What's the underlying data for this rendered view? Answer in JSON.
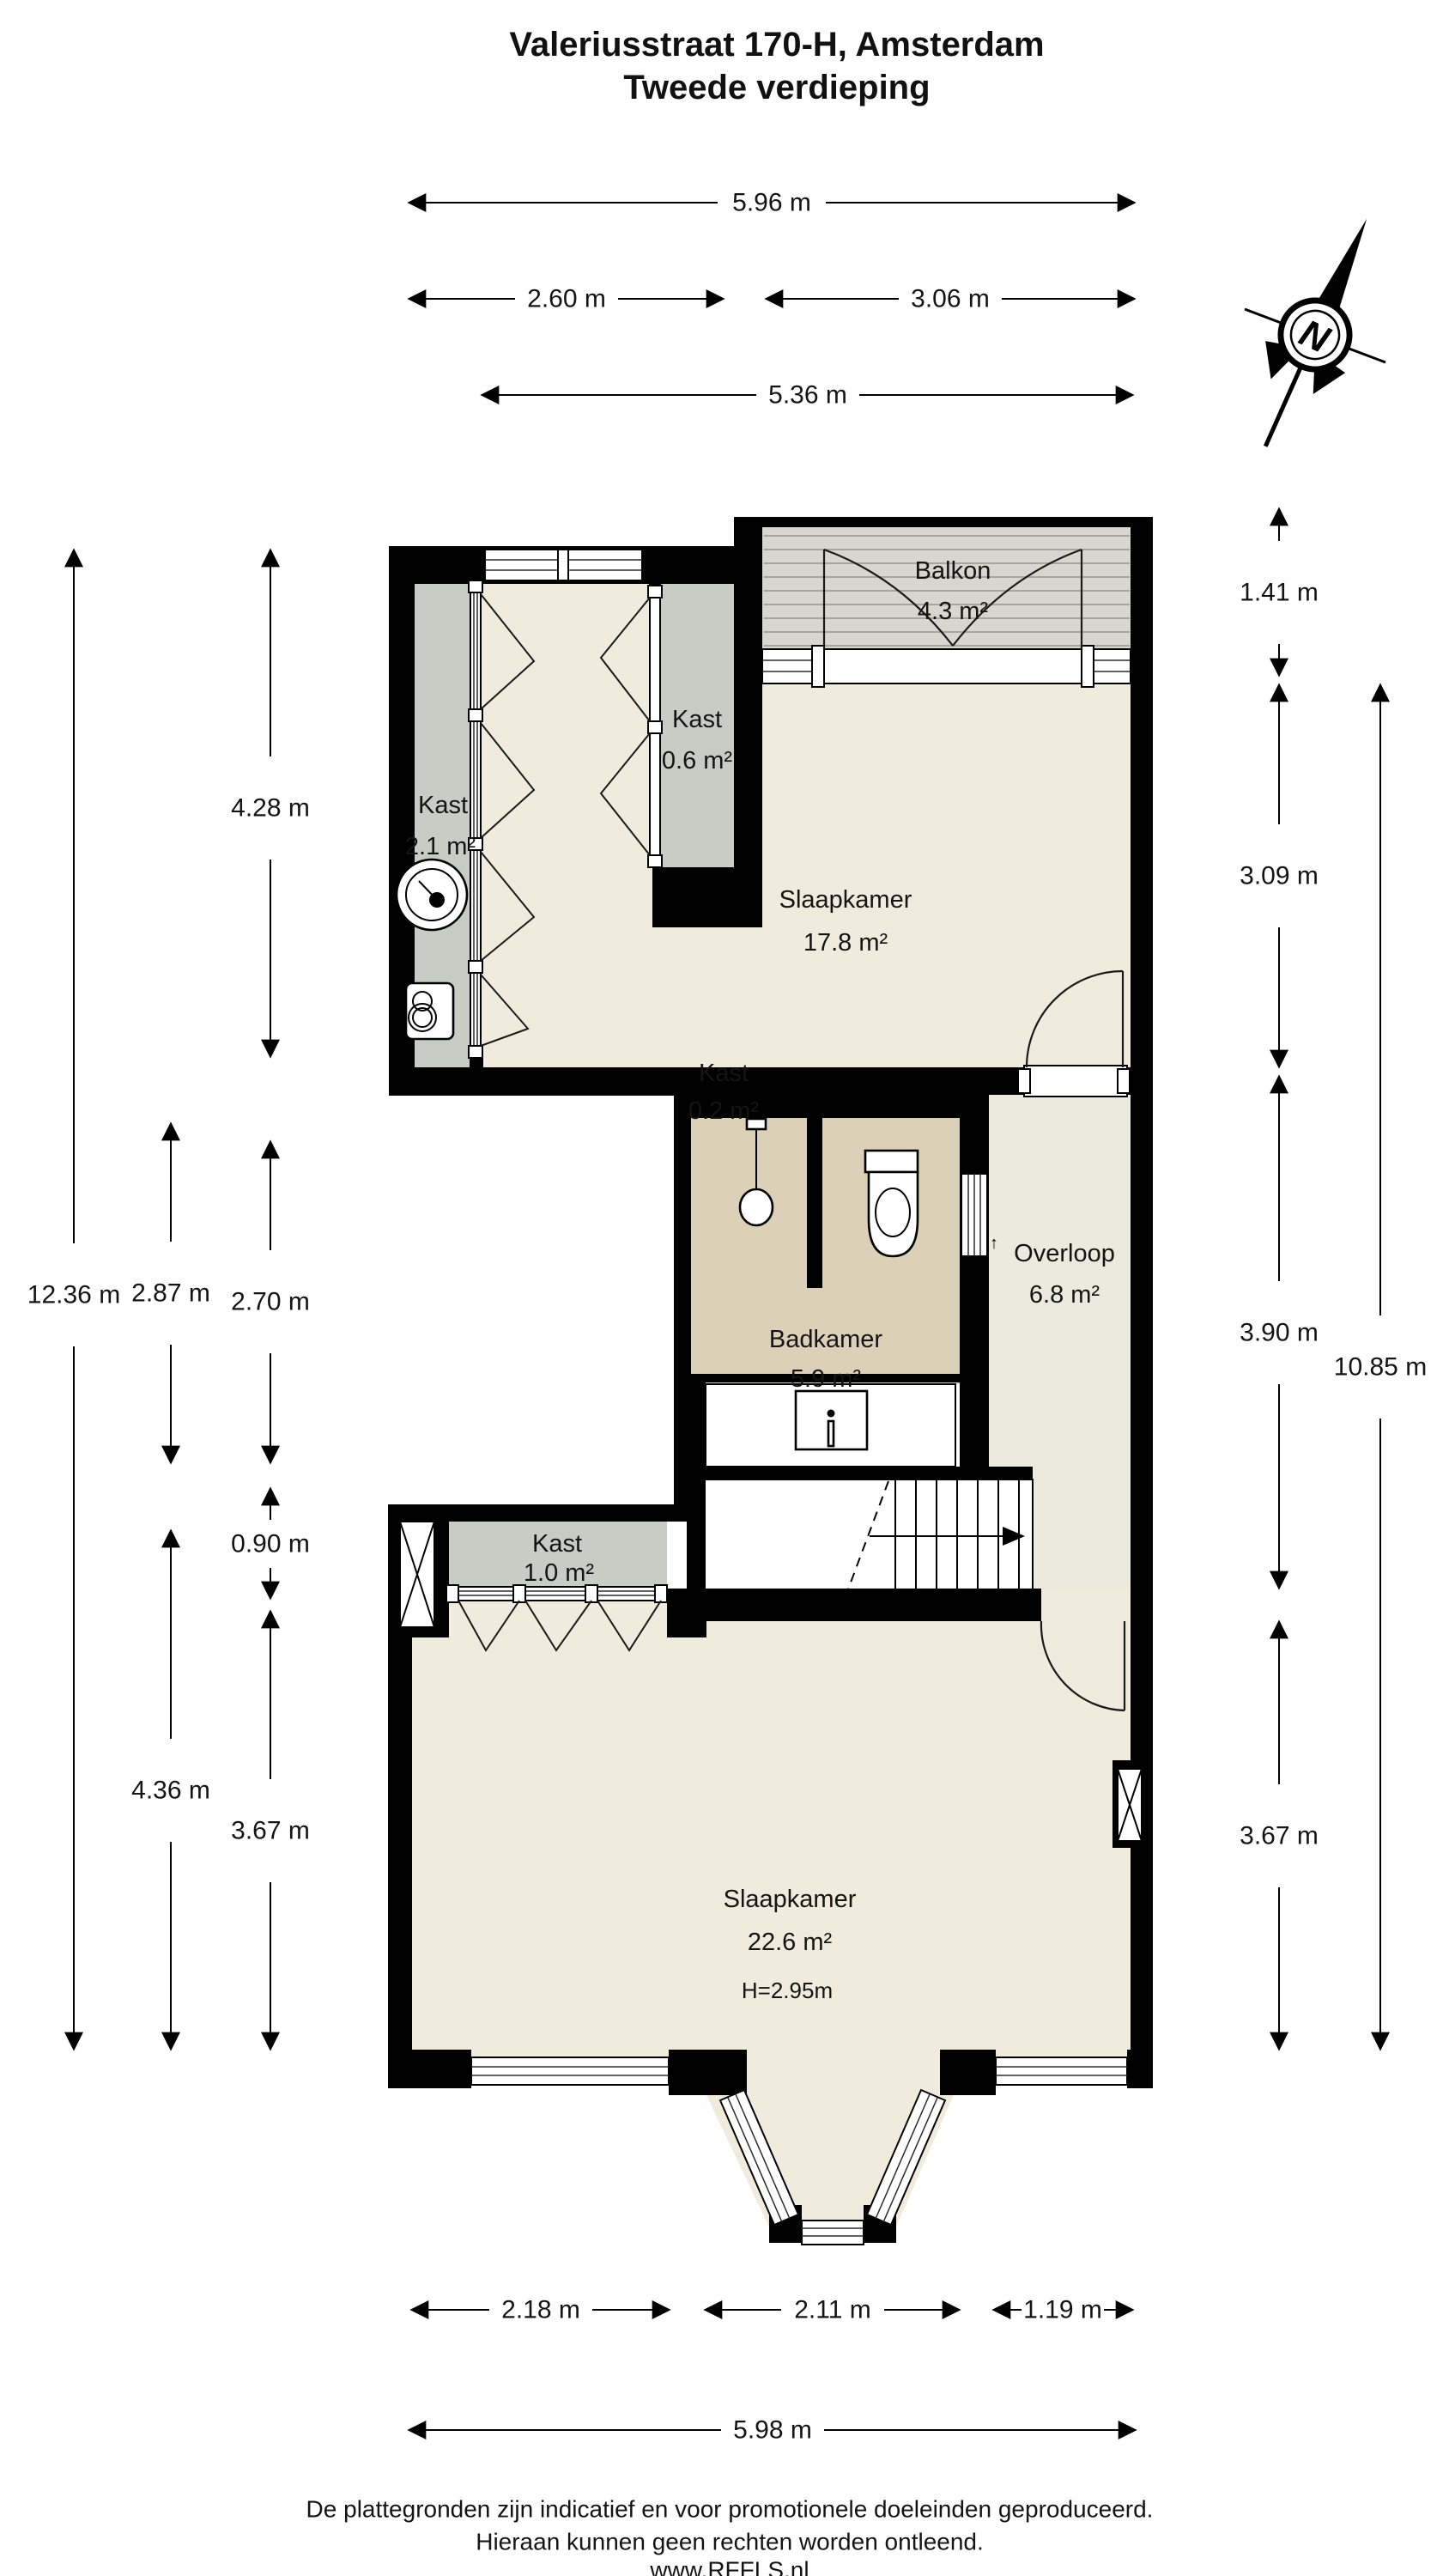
{
  "title": {
    "line1": "Valeriusstraat 170-H, Amsterdam",
    "line2": "Tweede verdieping"
  },
  "rooms": {
    "kast_top": {
      "name": "Kast",
      "area": "0.6 m²"
    },
    "balkon": {
      "name": "Balkon",
      "area": "4.3 m²"
    },
    "kast_left": {
      "name": "Kast",
      "area": "2.1 m²"
    },
    "slaapkamer1": {
      "name": "Slaapkamer",
      "area": "17.8 m²"
    },
    "kast_mini": {
      "name": "Kast",
      "area": "0.2 m²"
    },
    "badkamer": {
      "name": "Badkamer",
      "area": "5.9 m²"
    },
    "overloop": {
      "name": "Overloop",
      "area": "6.8 m²"
    },
    "kast_hal": {
      "name": "Kast",
      "area": "1.0 m²"
    },
    "slaapkamer2": {
      "name": "Slaapkamer",
      "area": "22.6 m²",
      "height": "H=2.95m"
    }
  },
  "dimensions": {
    "top_total": "5.96 m",
    "top_left": "2.60 m",
    "top_right": "3.06 m",
    "top_inner": "5.36 m",
    "left_total": "12.36 m",
    "left_upper": "4.28 m",
    "left_mid_a": "2.87 m",
    "left_mid_b": "2.70 m",
    "left_kast": "0.90 m",
    "left_lower": "4.36 m",
    "left_bedroom": "3.67 m",
    "right_balcony": "1.41 m",
    "right_bedroom1": "3.09 m",
    "right_mid": "3.90 m",
    "right_total": "10.85 m",
    "right_bedroom2": "3.67 m",
    "bottom_left": "2.18 m",
    "bottom_bay": "2.11 m",
    "bottom_right": "1.19 m",
    "bottom_total": "5.98 m"
  },
  "compass": {
    "north_label": "N"
  },
  "misc": {
    "tiny_arrow": "↑"
  },
  "icons": {
    "compass": "north-arrow-icon",
    "washer": "washing-machine-icon",
    "boiler": "boiler-icon",
    "sink": "sink-icon",
    "toilet": "toilet-icon",
    "shower": "shower-icon",
    "stairs": "stairs-direction-arrow-icon"
  },
  "colors": {
    "wall": "#000000",
    "floor": "#f0ebdd",
    "floor_landing": "#eceade",
    "closet": "#c8ccc5",
    "balcony_deck": "#d8d7cf",
    "bathroom": "#ddd0b8"
  },
  "footer": {
    "line1": "De plattegronden zijn indicatief en voor promotionele doeleinden geproduceerd.",
    "line2": "Hieraan kunnen geen rechten worden ontleend.",
    "line3": "www.RFFLS.nl"
  }
}
